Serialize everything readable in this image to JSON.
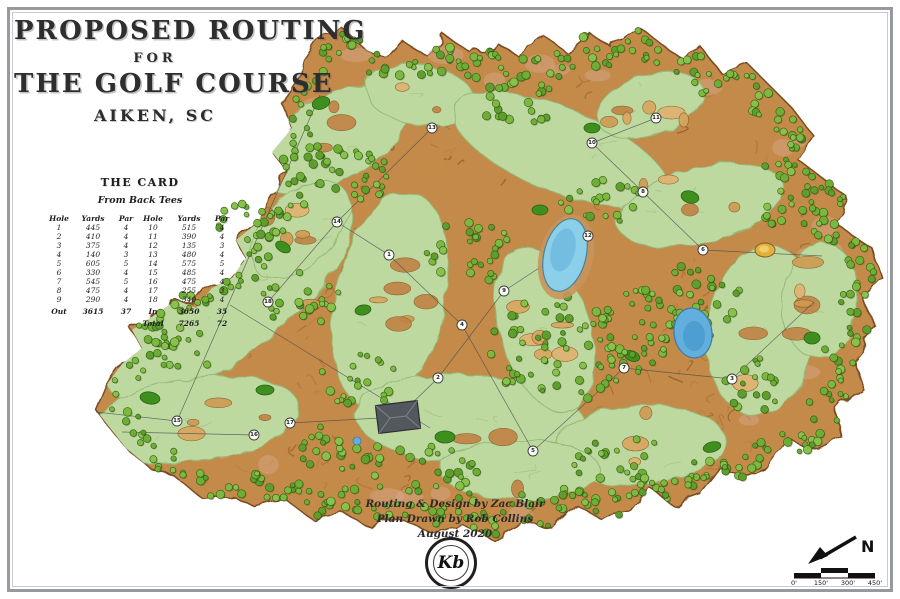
{
  "title": {
    "line1": "PROPOSED ROUTING",
    "line2": "FOR",
    "line3": "THE GOLF COURSE",
    "line4": "AIKEN, SC"
  },
  "card": {
    "title": "THE CARD",
    "subtitle": "From Back Tees",
    "columns": [
      "Hole",
      "Yards",
      "Par",
      "Hole",
      "Yards",
      "Par"
    ],
    "front": [
      {
        "hole": "1",
        "yards": "445",
        "par": "4"
      },
      {
        "hole": "2",
        "yards": "410",
        "par": "4"
      },
      {
        "hole": "3",
        "yards": "375",
        "par": "4"
      },
      {
        "hole": "4",
        "yards": "140",
        "par": "3"
      },
      {
        "hole": "5",
        "yards": "605",
        "par": "5"
      },
      {
        "hole": "6",
        "yards": "330",
        "par": "4"
      },
      {
        "hole": "7",
        "yards": "545",
        "par": "5"
      },
      {
        "hole": "8",
        "yards": "475",
        "par": "4"
      },
      {
        "hole": "9",
        "yards": "290",
        "par": "4"
      }
    ],
    "back": [
      {
        "hole": "10",
        "yards": "515",
        "par": "4"
      },
      {
        "hole": "11",
        "yards": "390",
        "par": "4"
      },
      {
        "hole": "12",
        "yards": "135",
        "par": "3"
      },
      {
        "hole": "13",
        "yards": "480",
        "par": "4"
      },
      {
        "hole": "14",
        "yards": "575",
        "par": "5"
      },
      {
        "hole": "15",
        "yards": "485",
        "par": "4"
      },
      {
        "hole": "16",
        "yards": "475",
        "par": "4"
      },
      {
        "hole": "17",
        "yards": "255",
        "par": "3"
      },
      {
        "hole": "18",
        "yards": "340",
        "par": "4"
      }
    ],
    "out_label": "Out",
    "out_yards": "3615",
    "out_par": "37",
    "in_label": "In",
    "in_yards": "3650",
    "in_par": "35",
    "total_label": "Total",
    "total_yards": "7265",
    "total_par": "72"
  },
  "credits": {
    "line1": "Routing & Design by Zac Blair",
    "line2": "Plan Drawn by Rob Collins",
    "line3": "August 2020"
  },
  "logo": {
    "monogram": "Kb"
  },
  "compass": {
    "north_label": "N"
  },
  "scale": {
    "labels": [
      "0'",
      "150'",
      "300'",
      "450'"
    ]
  },
  "map": {
    "hole_markers": [
      {
        "n": "1",
        "x": 389,
        "y": 255
      },
      {
        "n": "2",
        "x": 438,
        "y": 378
      },
      {
        "n": "3",
        "x": 732,
        "y": 379
      },
      {
        "n": "4",
        "x": 462,
        "y": 325
      },
      {
        "n": "5",
        "x": 533,
        "y": 451
      },
      {
        "n": "6",
        "x": 703,
        "y": 250
      },
      {
        "n": "7",
        "x": 624,
        "y": 368
      },
      {
        "n": "8",
        "x": 643,
        "y": 192
      },
      {
        "n": "9",
        "x": 504,
        "y": 291
      },
      {
        "n": "10",
        "x": 592,
        "y": 143
      },
      {
        "n": "11",
        "x": 656,
        "y": 118
      },
      {
        "n": "12",
        "x": 588,
        "y": 236
      },
      {
        "n": "13",
        "x": 432,
        "y": 128
      },
      {
        "n": "14",
        "x": 337,
        "y": 222
      },
      {
        "n": "15",
        "x": 177,
        "y": 421
      },
      {
        "n": "16",
        "x": 254,
        "y": 435
      },
      {
        "n": "17",
        "x": 290,
        "y": 423
      },
      {
        "n": "18",
        "x": 268,
        "y": 302
      }
    ],
    "colors": {
      "rough_sand": "#c48a4a",
      "rough_stroke": "#7a4c22",
      "fairway": "#bdd9a0",
      "fairway_stroke": "#94b978",
      "tree_greens": [
        "#6fae35",
        "#7db93e",
        "#5f9e2d",
        "#88c24a"
      ],
      "tree_stroke": "#335c17",
      "putting_green": "#3f8f1f",
      "pond_light": "#8ccfe9",
      "pond_dark": "#62aedd",
      "clubhouse_roof": "#53585e",
      "marker_fill": "#fdfdf8",
      "line": "#4a4e50"
    }
  }
}
